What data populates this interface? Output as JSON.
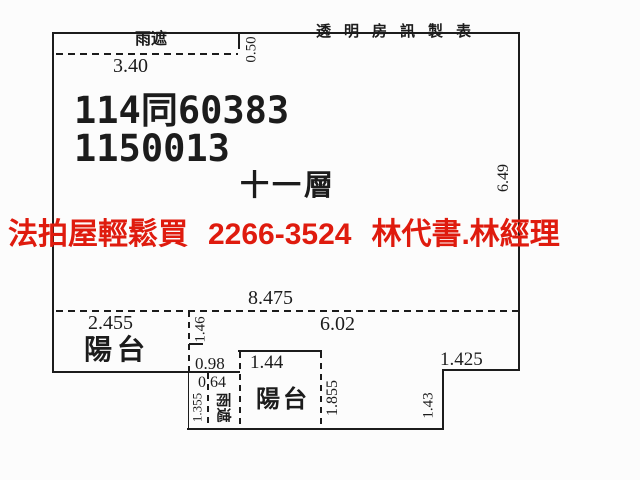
{
  "colors": {
    "ink": "#1c1c1c",
    "accent_red": "#df1b0e",
    "background": "#fcfcfc"
  },
  "header": {
    "publisher": "透明房訊製表"
  },
  "overlay_ad": {
    "agency": "法拍屋輕鬆買",
    "phone": "2266-3524",
    "contacts": "林代書.林經理"
  },
  "plan": {
    "case_number_line1": "114同60383",
    "case_number_line2": "1150013",
    "floor": "十一層",
    "top_canopy": {
      "name": "雨遮",
      "length": "3.40",
      "depth": "0.50"
    },
    "dimensions": {
      "right_height": "6.49",
      "interior_width_total": "8.475",
      "interior_width_inner": "6.02"
    },
    "left_balcony": {
      "name": "陽台",
      "width": "2.455",
      "depth": "1.46"
    },
    "bottom_middle": {
      "wall_segment": "0.98",
      "canopy_width": "0.64",
      "canopy_name": "雨遮",
      "canopy_height": "1.355"
    },
    "bottom_balcony": {
      "name": "陽台",
      "width": "1.44",
      "depth": "1.855"
    },
    "bottom_right_notch": {
      "width": "1.425",
      "height": "1.43"
    }
  }
}
